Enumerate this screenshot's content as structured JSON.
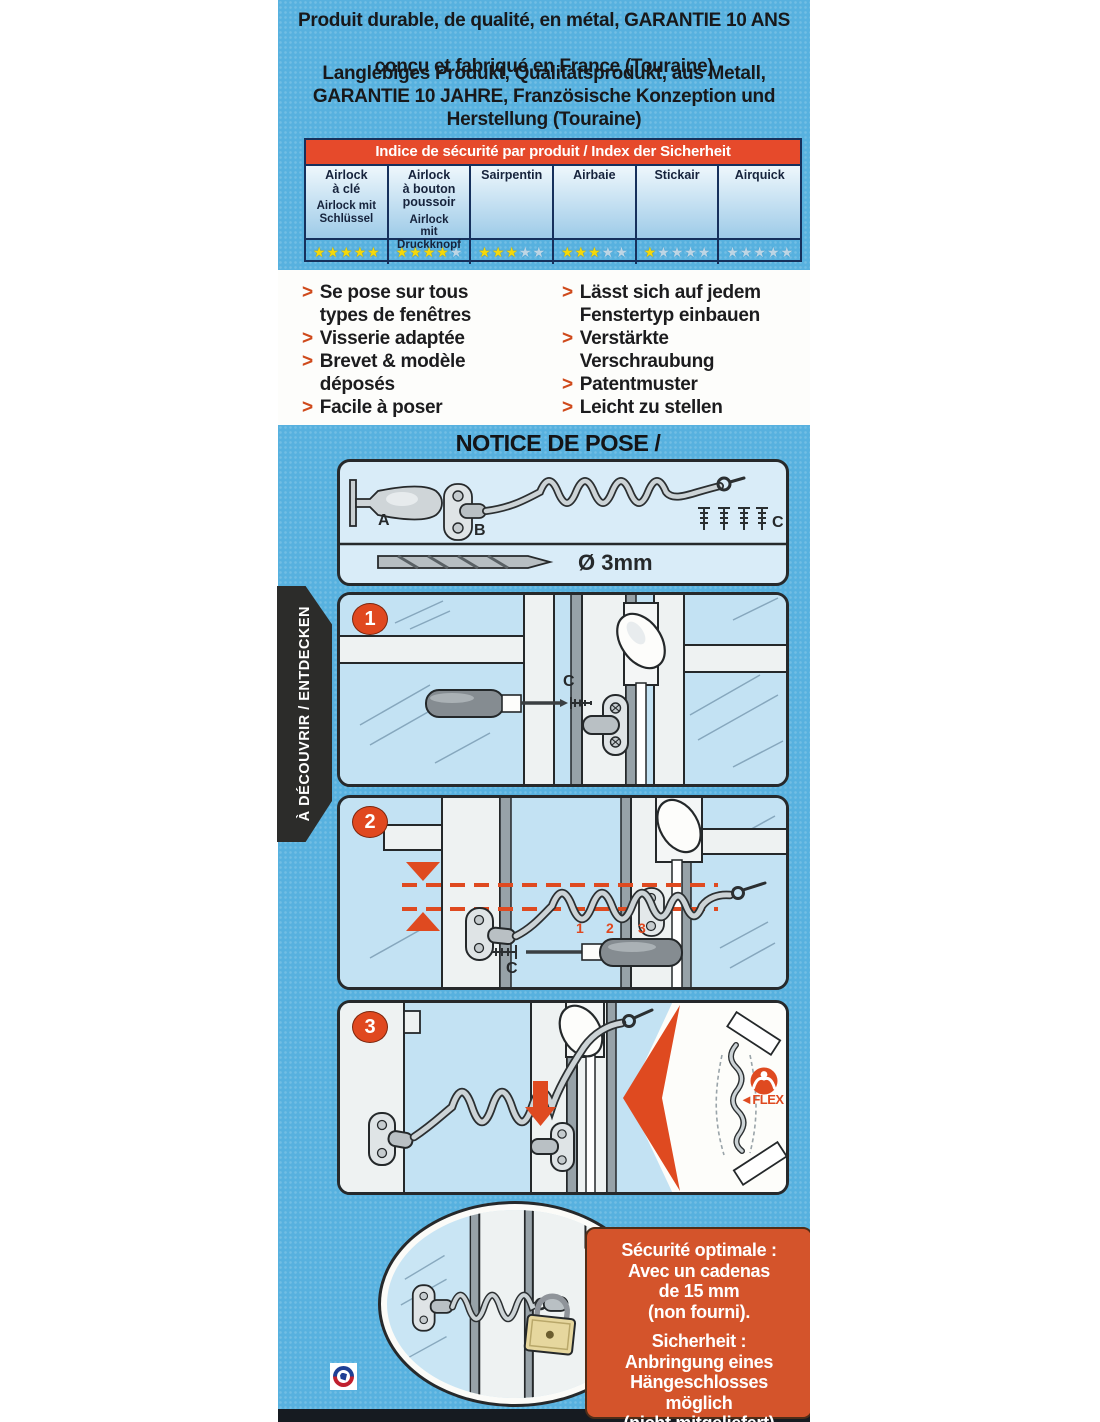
{
  "header": {
    "fr_lines": [
      "Produit durable, de qualité, en métal, GARANTIE 10 ANS",
      "conçu et fabriqué en France (Touraine)"
    ],
    "de_lines": [
      "Langlebiges Produkt, Qualitätsprodukt, aus Metall,",
      "GARANTIE 10 JAHRE, Französische Konzeption und",
      "Herstellung (Touraine)"
    ]
  },
  "security_table": {
    "title": "Indice de sécurité par produit / Index der Sicherheit",
    "max_stars": 5,
    "columns": [
      {
        "label_fr": "Airlock\nà clé",
        "label_de": "Airlock mit\nSchlüssel",
        "rating": 5
      },
      {
        "label_fr": "Airlock\nà bouton\npoussoir",
        "label_de": "Airlock\nmit\nDruckknopf",
        "rating": 4
      },
      {
        "label_fr": "Sairpentin",
        "label_de": "",
        "rating": 3
      },
      {
        "label_fr": "Airbaie",
        "label_de": "",
        "rating": 3
      },
      {
        "label_fr": "Stickair",
        "label_de": "",
        "rating": 1
      },
      {
        "label_fr": "Airquick",
        "label_de": "",
        "rating": 0
      }
    ]
  },
  "features": {
    "marker": ">",
    "fr": [
      "Se pose sur tous\ntypes de fenêtres",
      "Visserie adaptée",
      "Brevet & modèle\ndéposés",
      "Facile à poser"
    ],
    "de": [
      "Lässt sich auf jedem\nFenstertyp einbauen",
      "Verstärkte\nVerschraubung",
      "Patentmuster",
      "Leicht zu stellen"
    ]
  },
  "ribbon": {
    "label": "À DÉCOUVRIR / ENTDECKEN"
  },
  "notice": {
    "title": "NOTICE DE POSE / GEBRAUCHSANLEITUNG",
    "parts": {
      "label_a": "A",
      "label_b": "B",
      "label_c": "C",
      "drill_label": "Ø 3mm"
    },
    "steps": {
      "step1": {
        "number": "1",
        "screw_label": "C"
      },
      "step2": {
        "number": "2",
        "screw_label": "C",
        "loops": [
          "1",
          "2",
          "3"
        ]
      },
      "step3": {
        "number": "3",
        "flex_label": "◄FLEX"
      }
    }
  },
  "info_box": {
    "fr_lines": [
      "Sécurité optimale :",
      "Avec un cadenas",
      "de 15 mm",
      "(non fourni)."
    ],
    "de_lines": [
      "Sicherheit :",
      "Anbringung eines",
      "Hängeschlosses",
      "möglich",
      "(nicht mitgeliefert)"
    ]
  },
  "colors": {
    "background_blue": "#57b1df",
    "accent_orange": "#e0481f",
    "table_header_red": "#e64a2b",
    "star_yellow": "#f6d909",
    "info_box_orange": "#d4542b",
    "ribbon_black": "#2c2c2a"
  },
  "icons": [
    "made-in-france-badge",
    "screwdriver-icon",
    "screw-icon",
    "spring-icon",
    "padlock-icon",
    "strength-icon",
    "flex-arrow-icon"
  ]
}
